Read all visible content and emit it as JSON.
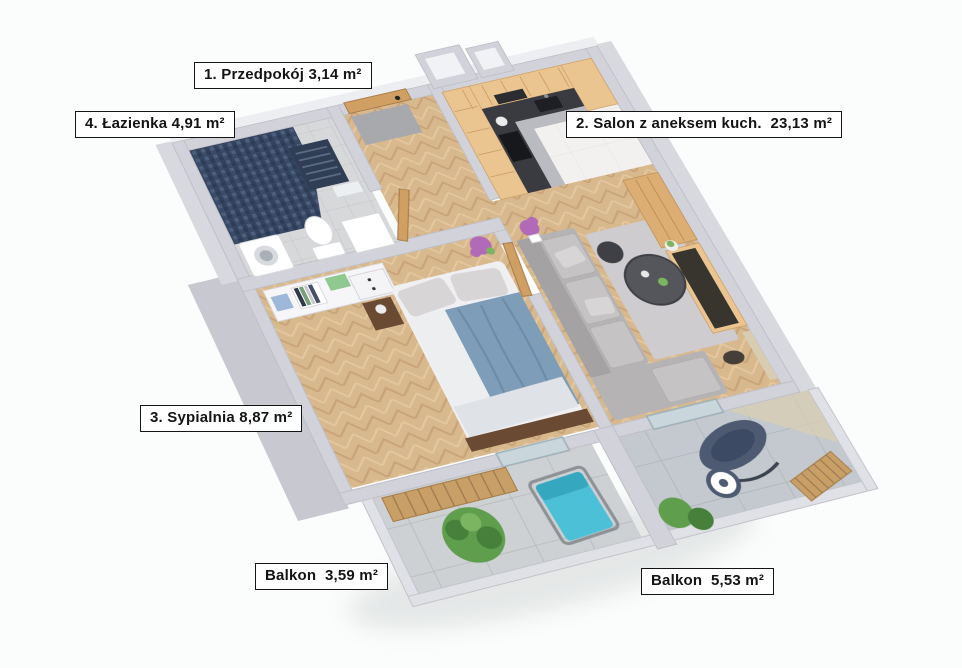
{
  "plan_type": "3d-apartment-floor-plan",
  "rooms": [
    {
      "id": "przedpokoj",
      "label": "1. Przedpokój 3,14 m²"
    },
    {
      "id": "lazienka",
      "label": "4. Łazienka 4,91 m²"
    },
    {
      "id": "salon",
      "label": "2. Salon z aneksem kuch.  23,13 m²"
    },
    {
      "id": "sypialnia",
      "label": "3. Sypialnia 8,87 m²"
    },
    {
      "id": "balkon_maly",
      "label": "Balkon  3,59 m²"
    },
    {
      "id": "balkon_duzy",
      "label": "Balkon  5,53 m²"
    }
  ],
  "palette": {
    "background": "#fbfdfc",
    "wall": "#d2d3da",
    "wall_face": "#c7c8d0",
    "wall_top": "#edeef2",
    "parapet": "#e0e1e6",
    "wood_cabinet": "#eac58f",
    "wood_cabinet_dark": "#dcae74",
    "wood_floor": "#d8b88d",
    "counter_dark": "#3a3b40",
    "white_floor": "#f2f1ef",
    "bath_tile": "#d7d8da",
    "mosaic_navy": "#374761",
    "sofa": "#b6b3b5",
    "cushion": "#c6c3c5",
    "rug": "#cecccf",
    "table_dark": "#55565c",
    "bed_duvet": "#7d9db8",
    "bed_sheet": "#eceef0",
    "dark_wood": "#6b4a33",
    "white_unit": "#f6f6f8",
    "door_wood": "#cf9f63",
    "glass": "#c9d6dc",
    "teal": "#4cc0d6",
    "plant": "#5f9e4c",
    "plant_dark": "#47803a",
    "flower": "#b06ab8",
    "navy": "#4e5a72",
    "bench_wood": "#c89f66",
    "balcony_tile": "#cdd1d3",
    "balcony_tile_right": "#c3c9ce",
    "mat": "#a8a9ad",
    "beige": "#d8cdb2"
  }
}
